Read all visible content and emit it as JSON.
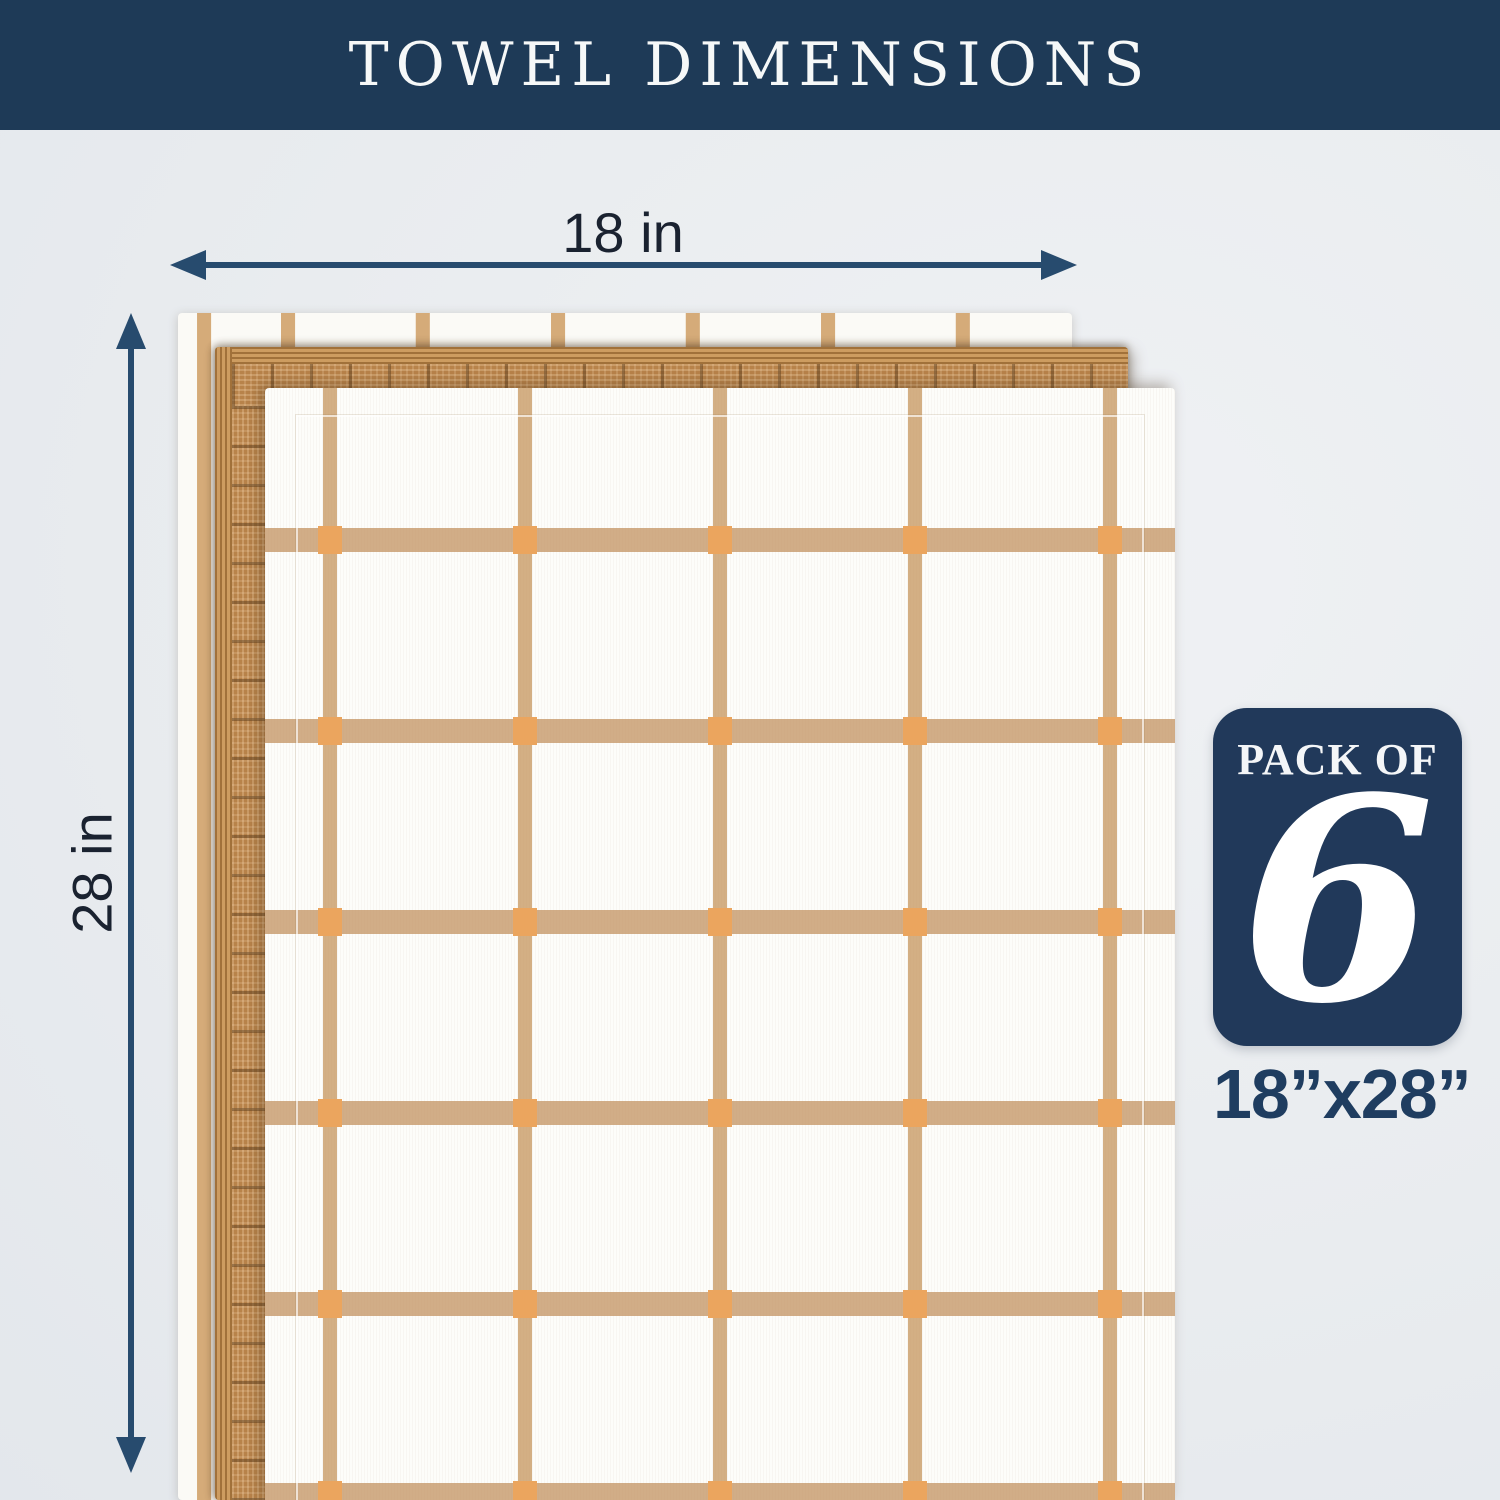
{
  "header": {
    "title": "TOWEL DIMENSIONS"
  },
  "diagram": {
    "width_dimension": {
      "label": "18 in"
    },
    "height_dimension": {
      "label": "28 in"
    }
  },
  "pack_badge": {
    "prefix": "PACK OF",
    "count": "6"
  },
  "size_caption": "18”x28”",
  "towel_stack": {
    "layers": [
      "white towel with tan vertical stripes",
      "tan towel with woven ornamental border",
      "white towel with tan windowpane check"
    ]
  },
  "colors": {
    "header_navy": "#1e3a57",
    "badge_navy": "#21395a",
    "arrow_navy": "#274b6e",
    "background": "#e9ecf0",
    "tan_body": "#bf8a50",
    "stripe_tan": "#d5ab79",
    "grid_tan": "#c89b67",
    "accent_orange": "#eba55e",
    "label_dark": "#1a2230",
    "caption_navy": "#1f3d60"
  }
}
